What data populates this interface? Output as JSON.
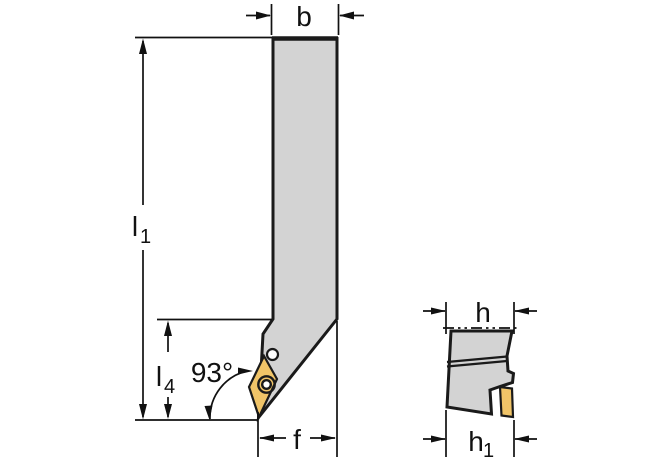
{
  "diagram": {
    "kind": "technical-drawing",
    "subject": "lathe-toolholder-two-views",
    "colors": {
      "body_fill": "#d3d3d3",
      "insert_fill": "#f0c468",
      "outline": "#1a1a1a",
      "dimension": "#111111",
      "background": "#ffffff"
    },
    "dimensions": {
      "b": {
        "label": "b"
      },
      "l1": {
        "base": "l",
        "sub": "1"
      },
      "l4": {
        "base": "l",
        "sub": "4"
      },
      "angle": {
        "label": "93°"
      },
      "f": {
        "label": "f"
      },
      "h": {
        "label": "h"
      },
      "h1": {
        "base": "h",
        "sub": "1"
      }
    }
  }
}
